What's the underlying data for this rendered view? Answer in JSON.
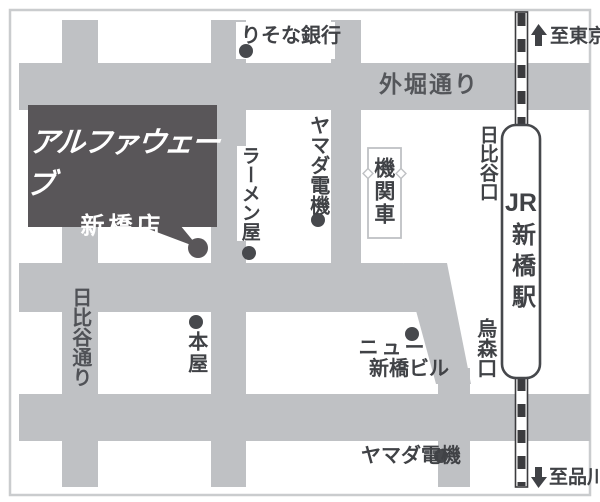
{
  "store": {
    "brand": "アルファウェーブ",
    "branch": "新橋店"
  },
  "streets": {
    "sotobori": "外堀通り",
    "hibiya_dori": "日比谷通り"
  },
  "station": {
    "jr": "JR",
    "name": "新橋駅",
    "hibiya_exit": "日比谷口",
    "karasumori_exit": "烏森口"
  },
  "directions": {
    "to_tokyo": "至東京",
    "to_shinagawa": "至品川"
  },
  "landmarks": {
    "risona_bank": "りそな銀行",
    "yamada_denki_top": "ヤマダ電機",
    "ramen_shop": "ラーメン屋",
    "locomotive": "機関車",
    "bookstore": "本屋",
    "new_shimbashi_line1": "ニュー",
    "new_shimbashi_line2": "新橋ビル",
    "yamada_denki_bottom": "ヤマダ電機"
  },
  "colors": {
    "street": "#bfc1c4",
    "ink": "#404246",
    "dark_box": "#595659",
    "border": "#caccce",
    "rail": "#3b3b3e",
    "paper": "#ffffff"
  }
}
